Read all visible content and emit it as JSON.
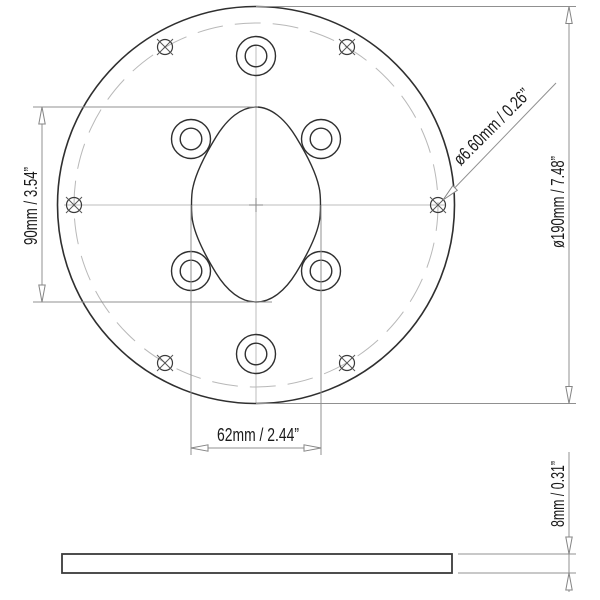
{
  "drawing": {
    "dimensions": {
      "cutout_height": "90mm / 3.54”",
      "cutout_width": "62mm / 2.44”",
      "outer_diameter": "ø190mm / 7.48”",
      "thickness": "8mm / 0.31”",
      "screw_hole_diameter": "ø6.60mm / 0.26”"
    },
    "features": {
      "screw_hole_count": 6,
      "counterbore_hole_count": 6
    },
    "colors": {
      "background": "#ffffff",
      "part_outline": "#2f2f2f",
      "dimension_lines": "#909090",
      "centerlines": "#bdbdbd",
      "text": "#1a1a1a"
    }
  }
}
